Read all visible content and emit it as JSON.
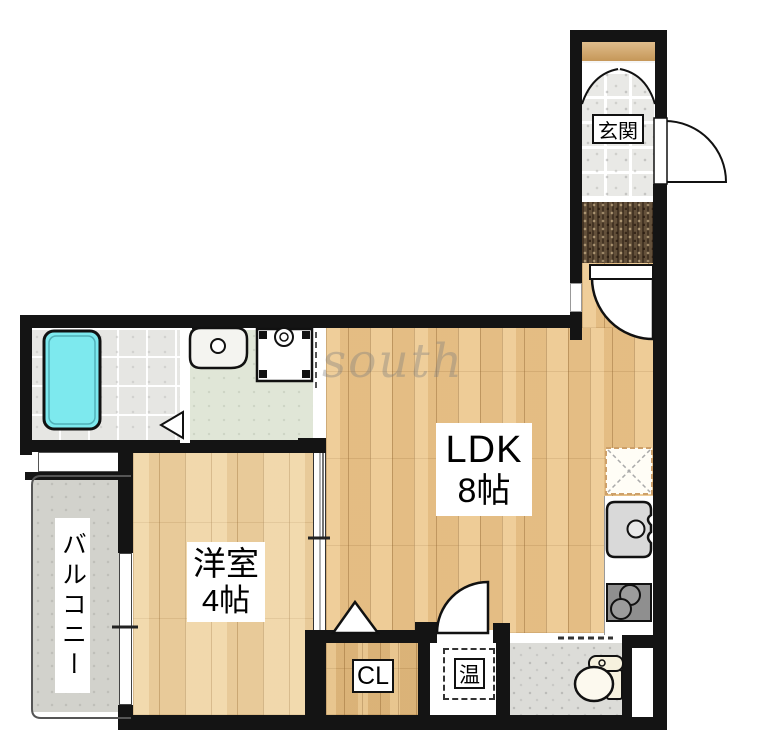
{
  "watermark": "south",
  "rooms": {
    "entrance": {
      "name": "玄関"
    },
    "ldk": {
      "name": "LDK",
      "size": "8帖"
    },
    "western_room": {
      "name": "洋室",
      "size": "4帖"
    },
    "balcony": {
      "name": "バルコニー"
    },
    "closet": {
      "name": "CL"
    },
    "water_heater": {
      "name": "温"
    }
  },
  "fixtures": [
    "bathtub",
    "washbasin",
    "washing-machine-pan",
    "kitchen-sink",
    "gas-stove",
    "refrigerator-space",
    "toilet",
    "doormat",
    "shoe-cabinet",
    "entrance-door",
    "entrance-hall-door",
    "ldk-service-door",
    "closet-folding-door",
    "bathroom-folding-door",
    "sliding-door",
    "windows",
    "balcony-railing"
  ],
  "colors": {
    "wall": "#141414",
    "ldk_wood": "#ebc68e",
    "western_room_wood": "#eed3a4",
    "closet_wood": "#e2bc82",
    "bathtub": "#7de9ee",
    "washroom_floor": "#e0e6d7",
    "bathroom_tile": "#e6e6e3",
    "balcony_floor": "#d2d2cc",
    "toilet_floor": "#dcdcd8",
    "doormat": "#63503a",
    "entrance_tile": "#e9e9e6",
    "shoe_cabinet": "#d6a765"
  }
}
